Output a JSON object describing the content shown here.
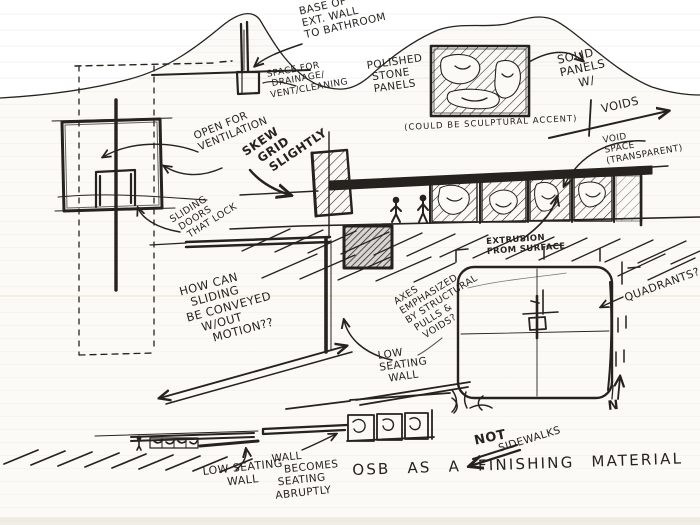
{
  "meta": {
    "description": "Hand-drawn architectural concept sketch page"
  },
  "colors": {
    "ink": "#26221e",
    "paper": "#fbfaf6",
    "scanner_white": "#ffffff",
    "bottom_band": "#e6e0d4"
  },
  "labels": {
    "base_of_ext_wall": "BASE OF\nEXT. WALL\nTO BATHROOM",
    "space_for_drainage": "SPACE FOR\n DRAINAGE/\nVENT/CLEANING",
    "polished_stone": "POLISHED\n STONE\n PANELS",
    "solid_panels": "SOLID\nPANELS\n    W/",
    "voids": "VOIDS",
    "sculptural_accent": "(COULD BE SCULPTURAL ACCENT)",
    "void_space": "VOID\nSPACE\n(TRANSPARENT)",
    "open_for_ventilation": "OPEN FOR\nVENTILATION",
    "skew_grid": "SKEW\n  GRID\n   SLIGHTLY",
    "sliding_doors": "SLIDING\n DOORS\n  THAT LOCK",
    "how_can_sliding": "HOW CAN\n  SLIDING\nBE CONVEYED\n   W/OUT\n     MOTION??",
    "extrusion": "EXTRUSION\nFROM SURFACE",
    "axes_emphasized": "AXES\nEMPHASIZED\nBY STRUCTURAL\n PULLS &\n  VOIDS?",
    "quadrants": "QUADRANTS?",
    "low_seating_wall_plan": "LOW\nSEATING\n  WALL",
    "low_seating_wall_elev": "LOW SEATING\n      WALL",
    "wall_becomes": "WALL\n   BECOMES\n SEATING\nABRUPTLY",
    "not_label": "NOT",
    "sidewalks": "SIDEWALKS",
    "osb": "OSB AS A FINISHING MATERIAL",
    "north": "N"
  }
}
